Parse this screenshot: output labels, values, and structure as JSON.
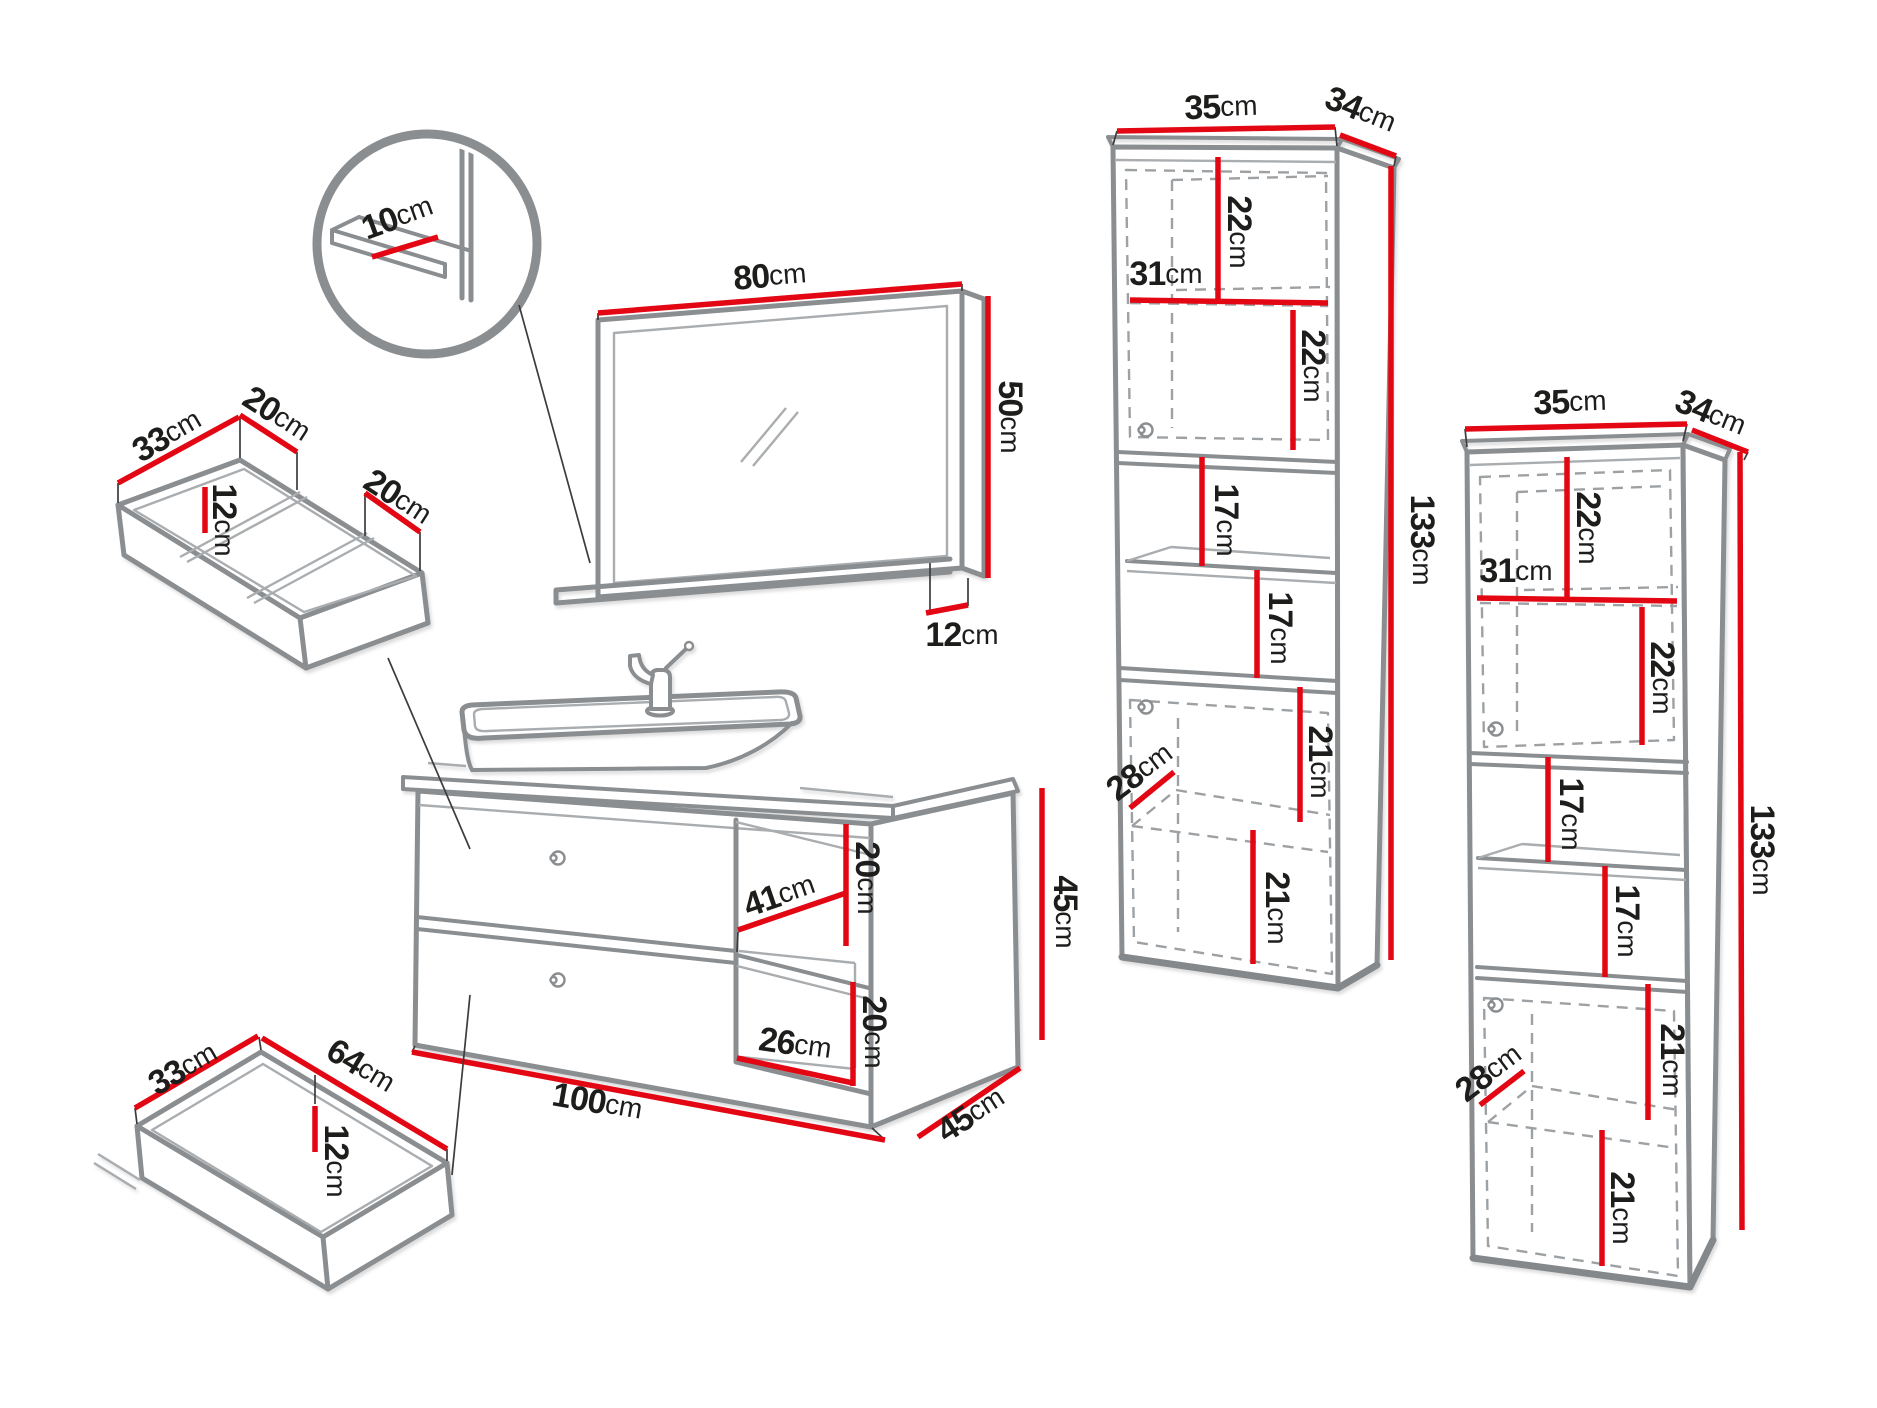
{
  "colors": {
    "dimension_red": "#e30613",
    "outline_gray": "#8b8e91",
    "text_black": "#1d1d1b",
    "background": "#ffffff"
  },
  "detail_circle": {
    "shelf_depth": {
      "v": "10",
      "u": "cm"
    }
  },
  "mirror": {
    "width": {
      "v": "80",
      "u": "cm"
    },
    "height": {
      "v": "50",
      "u": "cm"
    },
    "shelf_depth": {
      "v": "12",
      "u": "cm"
    }
  },
  "drawer_organizer": {
    "depth": {
      "v": "33",
      "u": "cm"
    },
    "left_width": {
      "v": "20",
      "u": "cm"
    },
    "height": {
      "v": "12",
      "u": "cm"
    },
    "right_width": {
      "v": "20",
      "u": "cm"
    }
  },
  "drawer": {
    "depth": {
      "v": "33",
      "u": "cm"
    },
    "width": {
      "v": "64",
      "u": "cm"
    },
    "height": {
      "v": "12",
      "u": "cm"
    }
  },
  "vanity": {
    "inner_depth": {
      "v": "41",
      "u": "cm"
    },
    "upper_shelf_height": {
      "v": "20",
      "u": "cm"
    },
    "lower_shelf_height": {
      "v": "20",
      "u": "cm"
    },
    "inner_width": {
      "v": "26",
      "u": "cm"
    },
    "width": {
      "v": "100",
      "u": "cm"
    },
    "depth": {
      "v": "45",
      "u": "cm"
    },
    "height": {
      "v": "45",
      "u": "cm"
    }
  },
  "tall_cabinet_left": {
    "width": {
      "v": "35",
      "u": "cm"
    },
    "depth": {
      "v": "34",
      "u": "cm"
    },
    "top_shelf": {
      "v": "22",
      "u": "cm"
    },
    "inner_width": {
      "v": "31",
      "u": "cm"
    },
    "top_lower_shelf": {
      "v": "22",
      "u": "cm"
    },
    "middle_shelf_1": {
      "v": "17",
      "u": "cm"
    },
    "middle_shelf_2": {
      "v": "17",
      "u": "cm"
    },
    "bottom_upper": {
      "v": "21",
      "u": "cm"
    },
    "inner_depth": {
      "v": "28",
      "u": "cm"
    },
    "bottom_lower": {
      "v": "21",
      "u": "cm"
    },
    "height": {
      "v": "133",
      "u": "cm"
    }
  },
  "tall_cabinet_right": {
    "width": {
      "v": "35",
      "u": "cm"
    },
    "depth": {
      "v": "34",
      "u": "cm"
    },
    "top_shelf": {
      "v": "22",
      "u": "cm"
    },
    "inner_width": {
      "v": "31",
      "u": "cm"
    },
    "top_lower_shelf": {
      "v": "22",
      "u": "cm"
    },
    "middle_shelf_1": {
      "v": "17",
      "u": "cm"
    },
    "middle_shelf_2": {
      "v": "17",
      "u": "cm"
    },
    "bottom_upper": {
      "v": "21",
      "u": "cm"
    },
    "inner_depth": {
      "v": "28",
      "u": "cm"
    },
    "bottom_lower": {
      "v": "21",
      "u": "cm"
    },
    "height": {
      "v": "133",
      "u": "cm"
    }
  }
}
